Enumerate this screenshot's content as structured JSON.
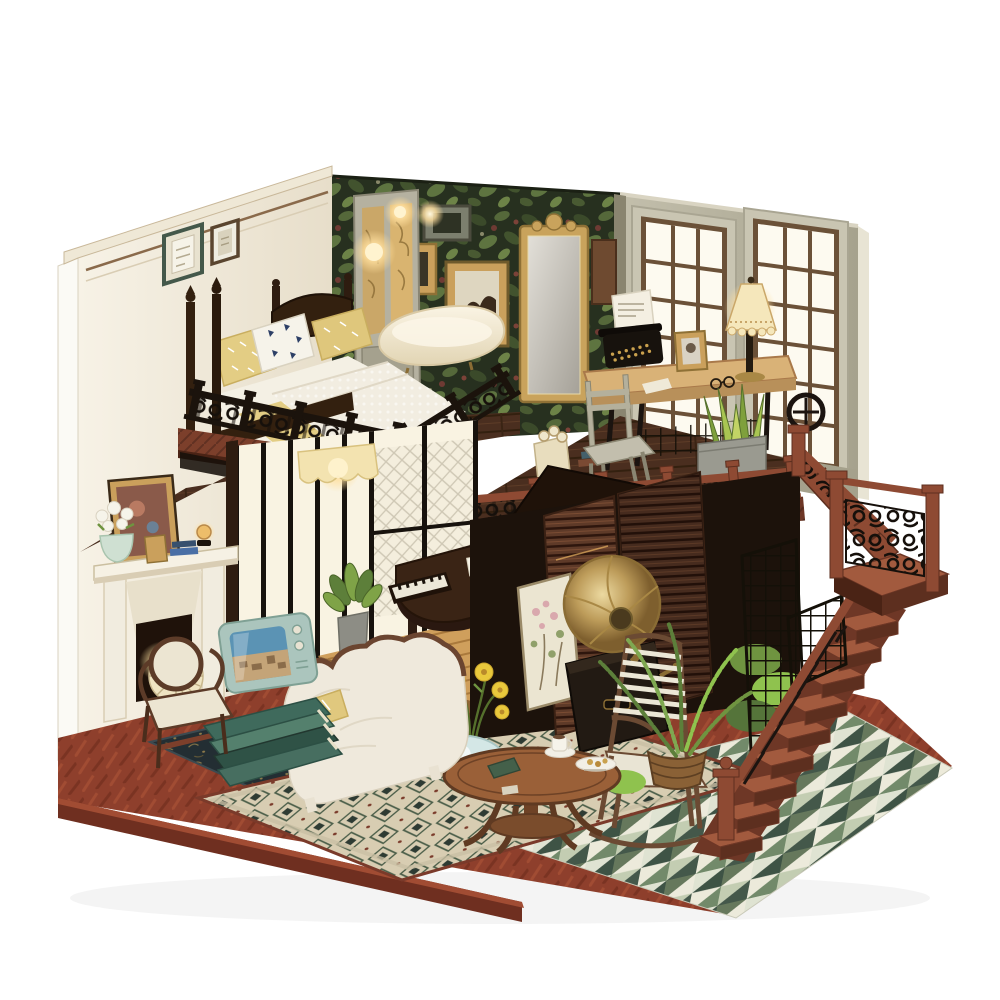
{
  "image": {
    "kind": "product photograph",
    "subject": "DIY miniature dollhouse kit — two-story vintage loft diorama",
    "alt": "Handcrafted miniature wooden loft dollhouse on a white background: upstairs bedroom with four-poster bed, clawfoot bathtub and gilt mirror on botanical wallpaper, a study with typewriter desk and lace-shade lamp by French windows; downstairs living room with grand piano on a wooden dais, fireplace, retro television on stacked books, carved white sofa, gramophone with brass horn, white rocking chair, round coffee table with tea set and yellow daisies in a blue vase; mahogany staircase with black scrollwork balustrades, ferns, patterned rugs and green triangle mosaic tiles.",
    "background": "#ffffff"
  },
  "scene": {
    "style": "warm vintage loft interior miniature, lit with tiny LEDs",
    "lighting": [
      "glowing door-panel lamps",
      "desk lamp with lace shade",
      "scalloped awning sconce",
      "fireplace ember glow",
      "amber orb lamp"
    ],
    "rooms": [
      {
        "name": "loft-bedroom",
        "objects": [
          "four-poster bed",
          "yellow pillows with white print",
          "navy-print white pillow",
          "knitted throw over yellow duvet",
          "framed wall art",
          "panelled glass door with warm lights",
          "clawfoot bathtub",
          "gilt arch mirror",
          "botanical foliage wallpaper",
          "wall shelf with books"
        ]
      },
      {
        "name": "loft-study",
        "objects": [
          "treadle sewing-machine desk",
          "black typewriter with paper",
          "table lamp with lace shade",
          "gold photo frame",
          "reading glasses",
          "ladder-back chair",
          "snake plant in metal planter",
          "bag of paper scrolls",
          "spoked treadle wheel"
        ]
      },
      {
        "name": "living-room",
        "objects": [
          "grand piano with open lid on golden dais",
          "piano stool",
          "potted plant",
          "scalloped awning light",
          "white fireplace mantel",
          "framed painting above mantel",
          "flower pot with white blooms",
          "amber orb lamp",
          "pleated round fan",
          "cameo-back armchair",
          "stack of green books",
          "mint retro television",
          "white carved-back sofa",
          "yellow leaf-print cushion"
        ]
      },
      {
        "name": "lounge-corner",
        "objects": [
          "round pedestal coffee table",
          "coffee cup, saucer and dessert plate",
          "blue vase with yellow daisies",
          "white slat-back rocking chair",
          "gramophone with brass horn",
          "leaning blossom painting",
          "slatted wood screens",
          "black trellis panels",
          "fern in woven basket"
        ]
      },
      {
        "name": "staircase",
        "objects": [
          "mahogany lower flight",
          "turned newel posts",
          "landing with scrollwork panel",
          "upper flight to balcony",
          "black lattice newel panel"
        ]
      }
    ],
    "floors": [
      "herringbone brick-red hardwood base",
      "navy fleur rug under sofa",
      "beige diamond-pattern area rug",
      "green triangle mosaic tile terrace"
    ],
    "balustrades": [
      "black scrollwork bedroom railing",
      "mahogany study railing with black scroll panels",
      "landing scroll panel"
    ]
  },
  "palette": {
    "bg": "#ffffff",
    "wallCream": "#f3eee1",
    "trim": "#8a6a4b",
    "foliage": "#27301f",
    "sage": "#b8b4a2",
    "espresso": "#33200f",
    "walnut": "#4a2e1f",
    "mahogany": "#8e4a33",
    "iron": "#16100b",
    "goldWood": "#cf9f5c",
    "brick": "#8e3f2c",
    "tileGreen": "#5f7355",
    "rugBeige": "#d8cdb2",
    "navyRug": "#232e33",
    "sofaWhite": "#efe9dc",
    "brass": "#bd9c5a",
    "glow": "#ffdf9e",
    "leaf": "#6f9440",
    "mintTV": "#aac4bd",
    "tubCream": "#f5eeda",
    "vaseBlue": "#d4e7e6",
    "bedYellow": "#e3cd84"
  }
}
